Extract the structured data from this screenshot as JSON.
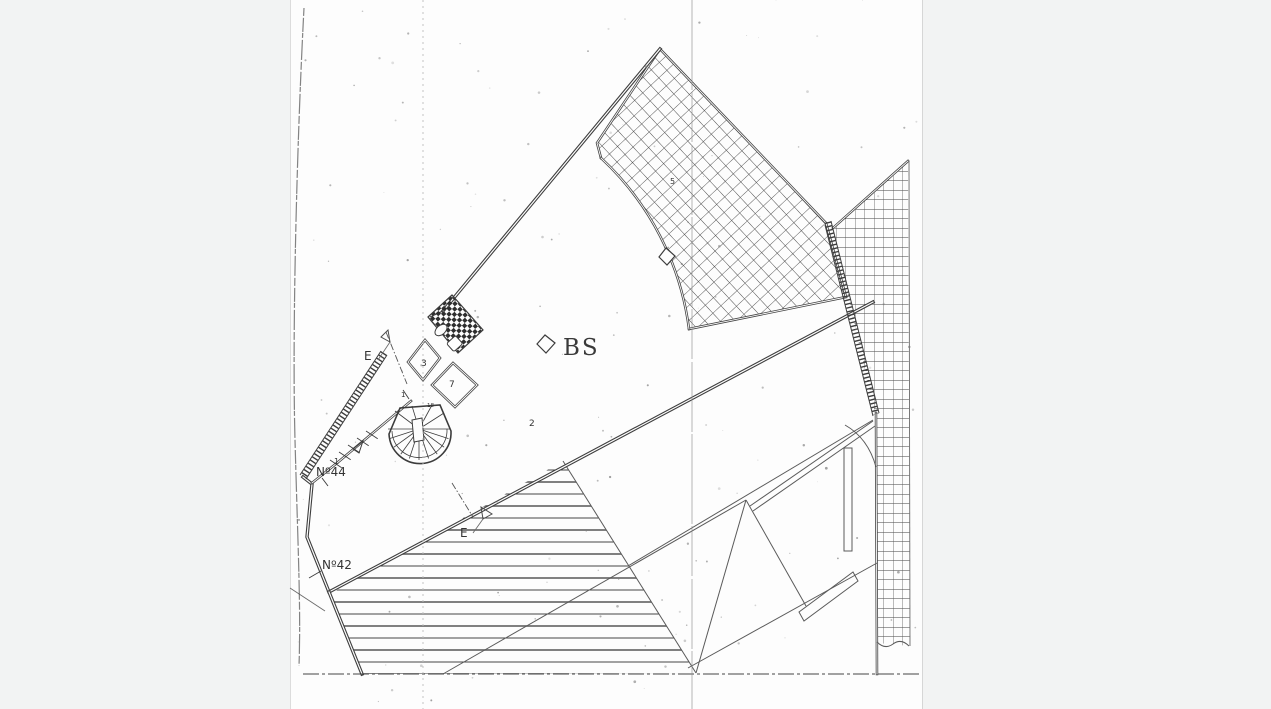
{
  "drawing": {
    "labels": {
      "bs": "BS",
      "house_number_44": "Nº44",
      "house_number_44_sup": "1",
      "house_number_42": "Nº42",
      "room_3": "3",
      "room_7": "7",
      "area_2": "2",
      "area_5": "5",
      "stair_step_18": "18",
      "corridor_mark_1": "1",
      "section_marker_upper": "E",
      "section_marker_lower": "E"
    },
    "colors": {
      "ink": "#3e3e3e",
      "page": "#fdfdfd",
      "margin": "#f2f3f3"
    }
  }
}
